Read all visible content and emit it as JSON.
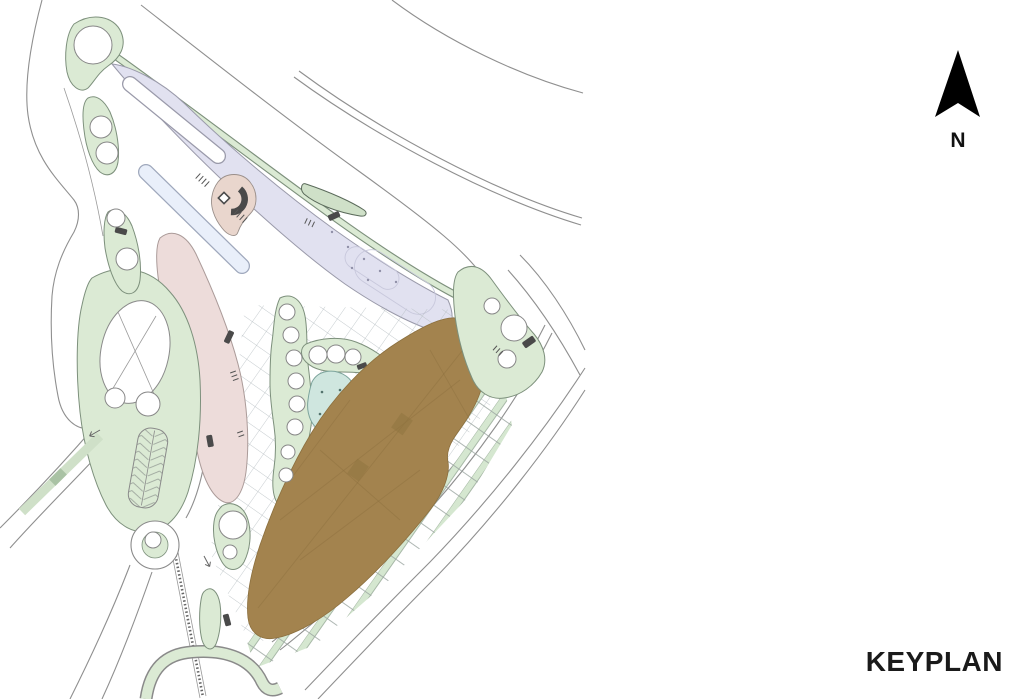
{
  "texts": {
    "north_label": "N",
    "keyplan_label": "KEYPLAN"
  },
  "colors": {
    "background": "#ffffff",
    "road_line": "#8f8f8f",
    "green_fill": "#dbead4",
    "green_stroke": "#7d907c",
    "median_green_fill": "#cfe0c8",
    "crosswalk_green": "#a9c2a4",
    "lavender_fill": "#e1e1f0",
    "lavender_stroke": "#9a9aaa",
    "pink_fill": "#eddcda",
    "pink_stroke": "#ab9b99",
    "brown_fill": "#a3834e",
    "teal_pond_fill": "#cfe6df",
    "teal_pond_stroke": "#7da49c",
    "blue_sliver_fill": "#e9effa",
    "blue_sliver_stroke": "#9fa8bc",
    "white_sliver_fill": "#ffffff",
    "pavilion_beige_fill": "#e9d6cd",
    "dark_marker": "#4a4a4a",
    "tree_fill": "#ffffff",
    "tree_stroke": "#878787",
    "grid_hatch_line": "#b5bdc1",
    "north_arrow": "#000000",
    "label_text": "#1a1a1a"
  }
}
